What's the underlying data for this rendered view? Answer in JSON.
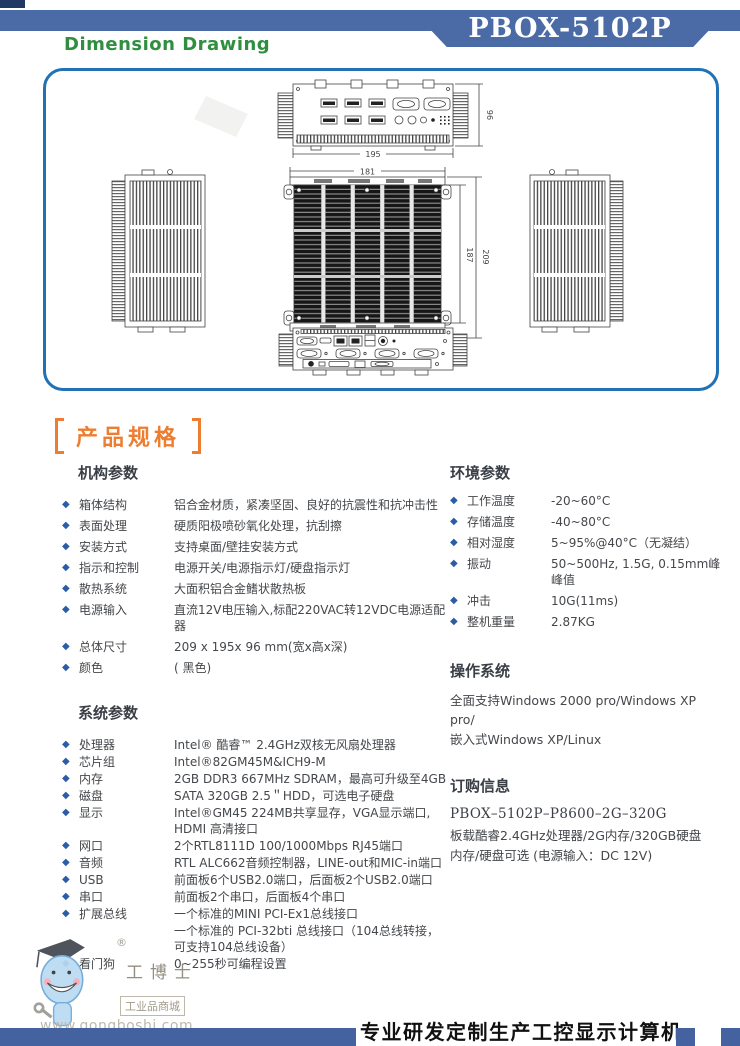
{
  "header": {
    "title": "Dimension Drawing",
    "model": "PBOX-5102P"
  },
  "icons": {
    "diamond": "◆"
  },
  "drawing": {
    "dims": {
      "rear_width": "195",
      "rear_height": "96",
      "top_width": "181",
      "depth_inner": "187",
      "depth_outer": "209"
    }
  },
  "specs": {
    "title": "产品规格",
    "mech": {
      "heading": "机构参数",
      "items": [
        {
          "label": "箱体结构",
          "value": "铝合金材质，紧凑坚固、良好的抗震性和抗冲击性"
        },
        {
          "label": "表面处理",
          "value": "硬质阳极喷砂氧化处理，抗刮擦"
        },
        {
          "label": "安装方式",
          "value": "支持桌面/壁挂安装方式"
        },
        {
          "label": "指示和控制",
          "value": "电源开关/电源指示灯/硬盘指示灯"
        },
        {
          "label": "散热系统",
          "value": "大面积铝合金鳍状散热板"
        },
        {
          "label": "电源输入",
          "value": "直流12V电压输入,标配220VAC转12VDC电源适配器"
        },
        {
          "label": "总体尺寸",
          "value": "209 x 195x 96 mm(宽x高x深)"
        },
        {
          "label": "颜色",
          "value": "( 黑色)"
        }
      ]
    },
    "system": {
      "heading": "系统参数",
      "items": [
        {
          "label": "处理器",
          "value": "Intel® 酷睿™ 2.4GHz双核无风扇处理器"
        },
        {
          "label": "芯片组",
          "value": "Intel®82GM45M&ICH9-M"
        },
        {
          "label": "内存",
          "value": "2GB DDR3  667MHz SDRAM，最高可升级至4GB"
        },
        {
          "label": "磁盘",
          "value": "SATA 320GB 2.5＂HDD，可选电子硬盘"
        },
        {
          "label": "显示",
          "value": "Intel®GM45 224MB共享显存，VGA显示端口, HDMI 高清接口"
        },
        {
          "label": "网口",
          "value": "2个RTL8111D 100/1000Mbps RJ45端口"
        },
        {
          "label": "音频",
          "value": "RTL ALC662音频控制器，LINE-out和MIC-in端口"
        },
        {
          "label": "USB",
          "value": "前面板6个USB2.0端口，后面板2个USB2.0端口"
        },
        {
          "label": "串口",
          "value": "前面板2个串口，后面板4个串口"
        },
        {
          "label": "扩展总线",
          "value": "一个标准的MINI PCI-Ex1总线接口",
          "value2": "一个标准的 PCI-32bti 总线接口（104总线转接，可支持104总线设备）"
        },
        {
          "label": "看门狗",
          "value": "0~255秒可编程设置"
        }
      ]
    },
    "env": {
      "heading": "环境参数",
      "items": [
        {
          "label": "工作温度",
          "value": "-20~60°C"
        },
        {
          "label": "存储温度",
          "value": "-40~80°C"
        },
        {
          "label": "相对湿度",
          "value": "5~95%@40°C（无凝结）"
        },
        {
          "label": "振动",
          "value": "50~500Hz, 1.5G, 0.15mm峰峰值"
        },
        {
          "label": "冲击",
          "value": "10G(11ms)"
        },
        {
          "label": "整机重量",
          "value": "2.87KG"
        }
      ]
    },
    "os": {
      "heading": "操作系统",
      "line1": "全面支持Windows 2000 pro/Windows XP pro/",
      "line2": "嵌入式Windows XP/Linux"
    },
    "order": {
      "heading": "订购信息",
      "model_line": "PBOX–5102P–P8600–2G–320G",
      "line1": "板载酷睿2.4GHz处理器/2G内存/320GB硬盘",
      "line2": "内存/硬盘可选  (电源输入：DC 12V)"
    }
  },
  "logo": {
    "registered": "®",
    "name": "工博士",
    "tagline": "工业品商城",
    "url": "www.gongboshi.com"
  },
  "footer": {
    "slogan": "专业研发定制生产工控显示计算机"
  },
  "colors": {
    "bar_blue": "#4A6BA6",
    "box_border": "#2271B5",
    "accent_orange": "#ED7D31",
    "bullet_blue": "#2B5CA8",
    "title_green": "#2F8F3F"
  }
}
